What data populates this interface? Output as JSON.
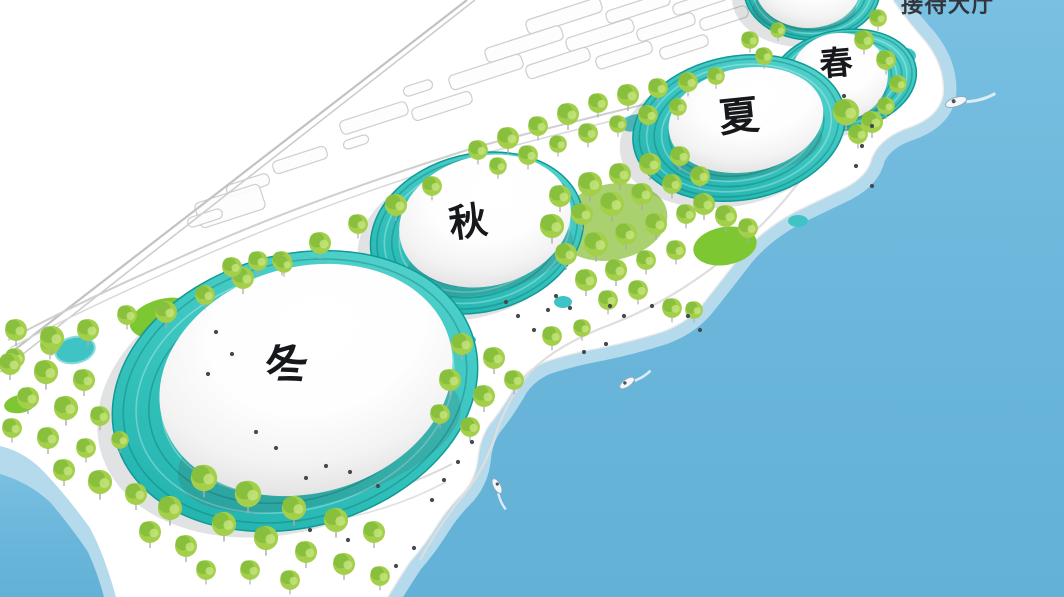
{
  "scene": {
    "type": "waterfront-dome-masterplan-rendering",
    "labels": {
      "reception": "接待大厅"
    },
    "domes": [
      {
        "id": "winter",
        "label": "冬"
      },
      {
        "id": "autumn",
        "label": "秋"
      },
      {
        "id": "summer",
        "label": "夏"
      },
      {
        "id": "spring",
        "label": "春"
      }
    ],
    "colors": {
      "sea": "#6cb7db",
      "shallow_water": "#b5daeb",
      "ring_teal": "#2fbdb8",
      "tree_green": "#a3cf4a",
      "lawn_green": "#7dc832",
      "pond_teal": "#3fc3c5",
      "dome_white": "#ffffff",
      "label_text": "#17181c"
    }
  }
}
